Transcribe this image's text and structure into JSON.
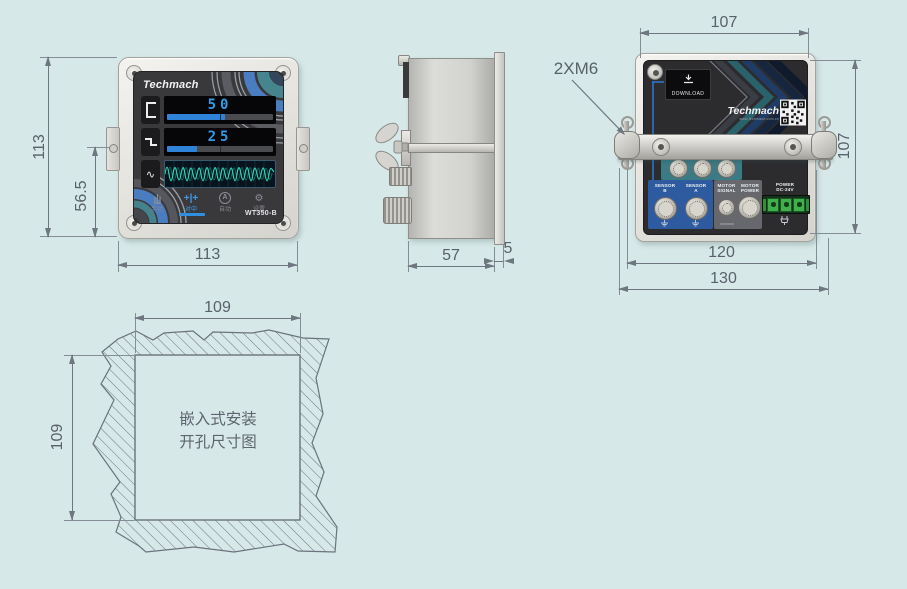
{
  "page": {
    "background": "#d6e8e8"
  },
  "front": {
    "brand": "Techmach",
    "model": "WT350-B",
    "value_top": "50",
    "value_bottom": "25",
    "bar_top_style": "width:55%",
    "bar_bottom_style": "width:28%",
    "menu": {
      "manual": "手动",
      "centering": "对中",
      "auto": "自动",
      "settings": "设置",
      "centering_icon": "+|+",
      "auto_icon_letter": "A",
      "gear_icon": "⚙",
      "wave_icon": "∿"
    },
    "dims": {
      "height": "113",
      "bracket_to_bottom": "56.5",
      "width": "113"
    }
  },
  "side": {
    "dims": {
      "depth": "57",
      "flange": "5"
    }
  },
  "back": {
    "screw_note": "2XM6",
    "download_label": "DOWNLOAD",
    "brand": "Techmach",
    "website": "www.techmach.com.cn",
    "ports": {
      "io": "IO",
      "other": "OTHER",
      "serial": "232&485",
      "sensor_b": "SENSOR\nB",
      "sensor_a": "SENSOR\nA",
      "motor_signal": "MOTOR\nSIGNAL",
      "motor_power": "MOTOR\nPOWER",
      "power": "POWER\nDC-24V"
    },
    "dims": {
      "mount_width": "107",
      "panel_height": "107",
      "bracket_width": "120",
      "overall_width": "130"
    }
  },
  "cutout": {
    "caption": "嵌入式安装\n开孔尺寸图",
    "dims": {
      "width": "109",
      "height": "109"
    }
  }
}
